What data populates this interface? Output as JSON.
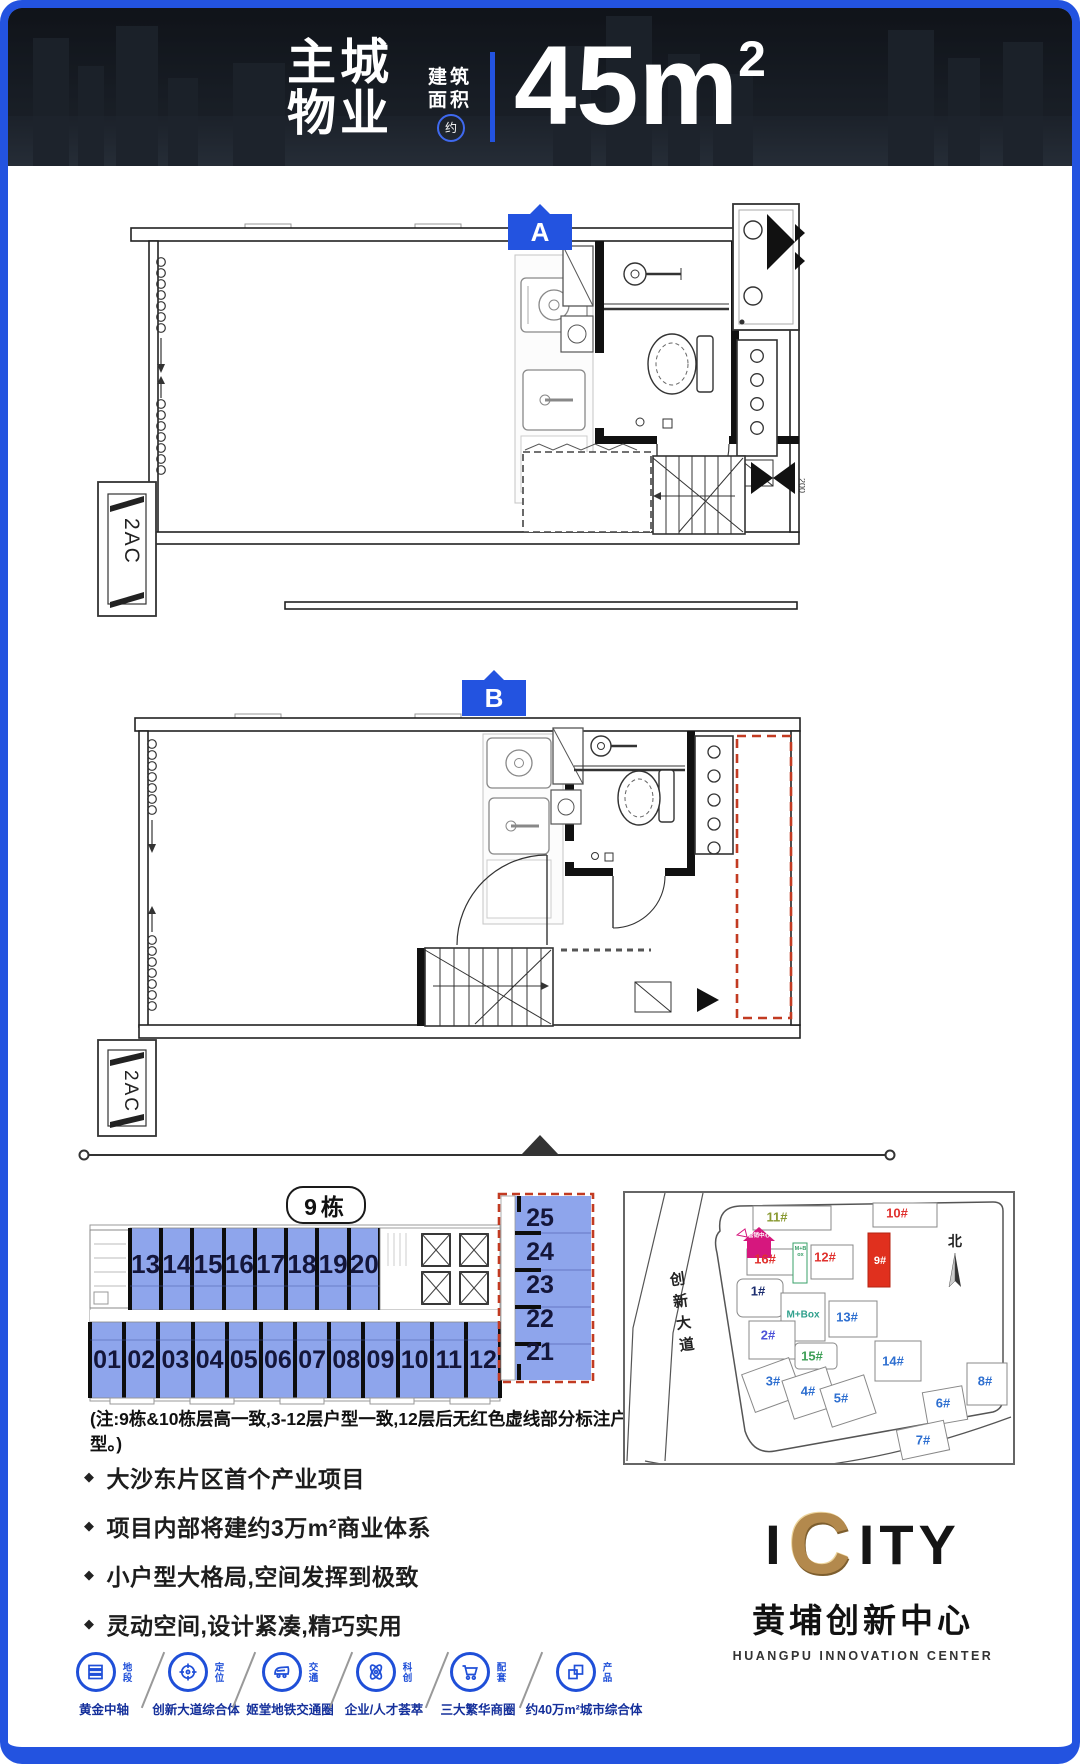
{
  "colors": {
    "accent_blue": "#2353e0",
    "unit_fill": "#8ea5ec",
    "dashed_red": "#c23b22",
    "building9_red": "#e0301e",
    "logo_gold": "#b3894d"
  },
  "header": {
    "title_line1": "主城",
    "title_line2": "物业",
    "area_label_line1": "建筑",
    "area_label_line2": "面积",
    "approx_badge": "约",
    "area_value": "45m",
    "area_sup": "2"
  },
  "plans": [
    {
      "marker": "A",
      "ac_label": "2AC",
      "dim_label": "200"
    },
    {
      "marker": "B",
      "ac_label": "2AC"
    }
  ],
  "building_section": {
    "building_label": "9栋",
    "top_row_units": [
      "13",
      "14",
      "15",
      "16",
      "17",
      "18",
      "19",
      "20"
    ],
    "bottom_row_units": [
      "01",
      "02",
      "03",
      "04",
      "05",
      "06",
      "07",
      "08",
      "09",
      "10",
      "11",
      "12"
    ],
    "side_column_units": [
      "25",
      "24",
      "23",
      "22",
      "21"
    ],
    "note": "(注:9栋&10栋层高一致,3-12层户型一致,12层后无红色虚线部分标注户型。)"
  },
  "site_map": {
    "road_label": "创新大道",
    "north_label": "北",
    "marketing_center_label": "营销中心",
    "small_box_label": "M+Box",
    "buildings": [
      {
        "id": "11#",
        "color": "#8a9a33"
      },
      {
        "id": "10#",
        "color": "#e0312e"
      },
      {
        "id": "16#",
        "color": "#e0312e"
      },
      {
        "id": "12#",
        "color": "#e0312e"
      },
      {
        "id": "9#",
        "color": "#ffffff"
      },
      {
        "id": "1#",
        "color": "#1b2c6e"
      },
      {
        "id": "M+Box",
        "color": "#2fa08c"
      },
      {
        "id": "13#",
        "color": "#2e6fd0"
      },
      {
        "id": "2#",
        "color": "#4d52d8"
      },
      {
        "id": "15#",
        "color": "#3f9f57"
      },
      {
        "id": "14#",
        "color": "#2e6fd0"
      },
      {
        "id": "3#",
        "color": "#2e6fd0"
      },
      {
        "id": "4#",
        "color": "#2e6fd0"
      },
      {
        "id": "5#",
        "color": "#2e6fd0"
      },
      {
        "id": "6#",
        "color": "#2e6fd0"
      },
      {
        "id": "8#",
        "color": "#2e6fd0"
      },
      {
        "id": "7#",
        "color": "#2e6fd0"
      }
    ]
  },
  "bullet_char": "◆",
  "features": [
    "大沙东片区首个产业项目",
    "项目内部将建约3万m²商业体系",
    "小户型大格局,空间发挥到极致",
    "灵动空间,设计紧凑,精巧实用"
  ],
  "logo": {
    "prefix": "I",
    "gold_letter": "C",
    "suffix": "ITY",
    "name_cn": "黄埔创新中心",
    "name_en": "HUANGPU INNOVATION CENTER"
  },
  "amenities": [
    {
      "icon": "district-icon",
      "tag": "地段",
      "label": "黄金中轴"
    },
    {
      "icon": "target-icon",
      "tag": "定位",
      "label": "创新大道综合体"
    },
    {
      "icon": "train-icon",
      "tag": "交通",
      "label": "姬堂地铁交通圈"
    },
    {
      "icon": "atom-icon",
      "tag": "科创",
      "label": "企业/人才荟萃"
    },
    {
      "icon": "cart-icon",
      "tag": "配套",
      "label": "三大繁华商圈"
    },
    {
      "icon": "product-icon",
      "tag": "产品",
      "label": "约40万m²城市综合体"
    }
  ]
}
